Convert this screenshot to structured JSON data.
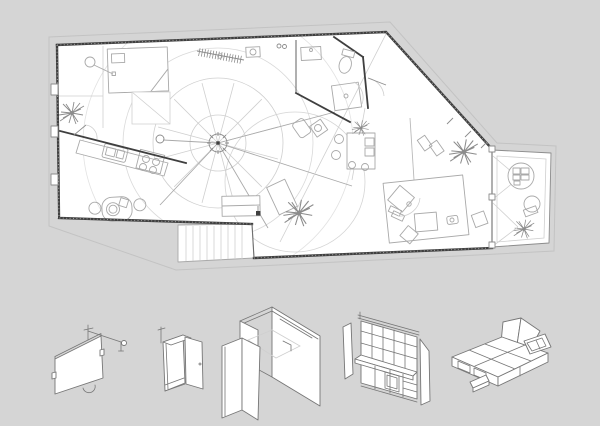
{
  "colors": {
    "background": "#d5d5d5",
    "paper": "#ffffff",
    "wall": "#3f3f3f",
    "wall-mid": "#6f6f6f",
    "line": "#a9a9a9",
    "line-mid": "#8c8c8c",
    "line-faint": "#cfcfcf",
    "contour": "#c3c3c3",
    "ax-line": "#767676"
  },
  "drawing": {
    "type": "architectural plan with axonometric furniture studies",
    "plan": {
      "label": "apartment floor plan",
      "rooms": [
        "sleeping-area",
        "kitchen",
        "dining-area",
        "bathroom",
        "living-area",
        "work-area",
        "rotating-room",
        "terrace",
        "stair-shaft"
      ],
      "fixtures": [
        "central-pivot-with-rotating-partition-circles",
        "kitchen-counter-sink-hob",
        "dining-table-with-chairs",
        "bed-platform",
        "coat-rack",
        "wash-basin",
        "toilet",
        "shower",
        "desk-with-chairs",
        "lounge-chairs",
        "tilted-room-with-bed",
        "terrace-table-chair",
        "stair-treads",
        "plants",
        "glazing-posts"
      ]
    },
    "axonometrics": {
      "label": "movable furniture elements",
      "items": [
        {
          "name": "pivoting-wall-panel"
        },
        {
          "name": "tall-cabinet-with-open-door"
        },
        {
          "name": "folding-room-enclosure"
        },
        {
          "name": "shelving-wall-unit-with-counter"
        },
        {
          "name": "platform-bed-with-storage-flaps"
        }
      ]
    }
  }
}
